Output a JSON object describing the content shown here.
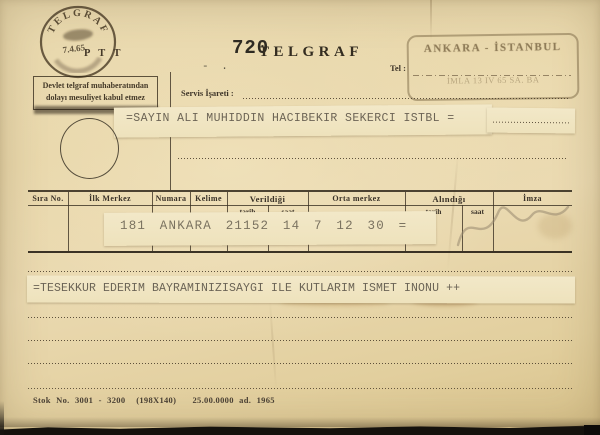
{
  "postmark": {
    "arc_text": "TELGRAF",
    "date": "7.4.65",
    "agency": "P T T"
  },
  "disclaimer": {
    "line1": "Devlet telgraf muhaberatından",
    "line2": "dolayı mesuliyet kabul etmez"
  },
  "header": {
    "typed_number": "720",
    "form_title": "TELGRAF",
    "typed_marks": "- .",
    "tel_label": "Tel :",
    "servis_label": "Servis İşareti :"
  },
  "route_stamp": {
    "line1": "ANKARA - İSTANBUL",
    "line2": "İMLA   13 IV 65   SA. BA"
  },
  "recipient_line": "=SAYIN ALI MUHIDDIN HACIBEKIR SEKERCI ISTBL =",
  "table": {
    "columns": [
      {
        "label": "Sıra No."
      },
      {
        "label": "İlk Merkez"
      },
      {
        "label": "Numara"
      },
      {
        "label": "Kelime"
      },
      {
        "label": "Verildiği"
      },
      {
        "label": "Orta merkez"
      },
      {
        "label": "Alındığı"
      },
      {
        "label": "İmza"
      }
    ],
    "sub_columns": [
      "tarih",
      "saat",
      "tarih",
      "saat"
    ],
    "entry_strip": "181 ANKARA 21152 14 7 12 30 ="
  },
  "message_strip": "=TESEKKUR EDERIM BAYRAMINIZISAYGI ILE KUTLARIM ISMET INONU ++",
  "footer": "Stok No. 3001 - 3200  (198X140)   25.00.0000 ad. 1965",
  "colors": {
    "paper": "#e8d7aa",
    "printed_ink": "#3d3428",
    "typed_ink": "#6e6759",
    "stamp_ink": "#5f4f36",
    "tape": "#f0e5c2",
    "pencil": "#9a8c76",
    "background": "#17140f"
  }
}
